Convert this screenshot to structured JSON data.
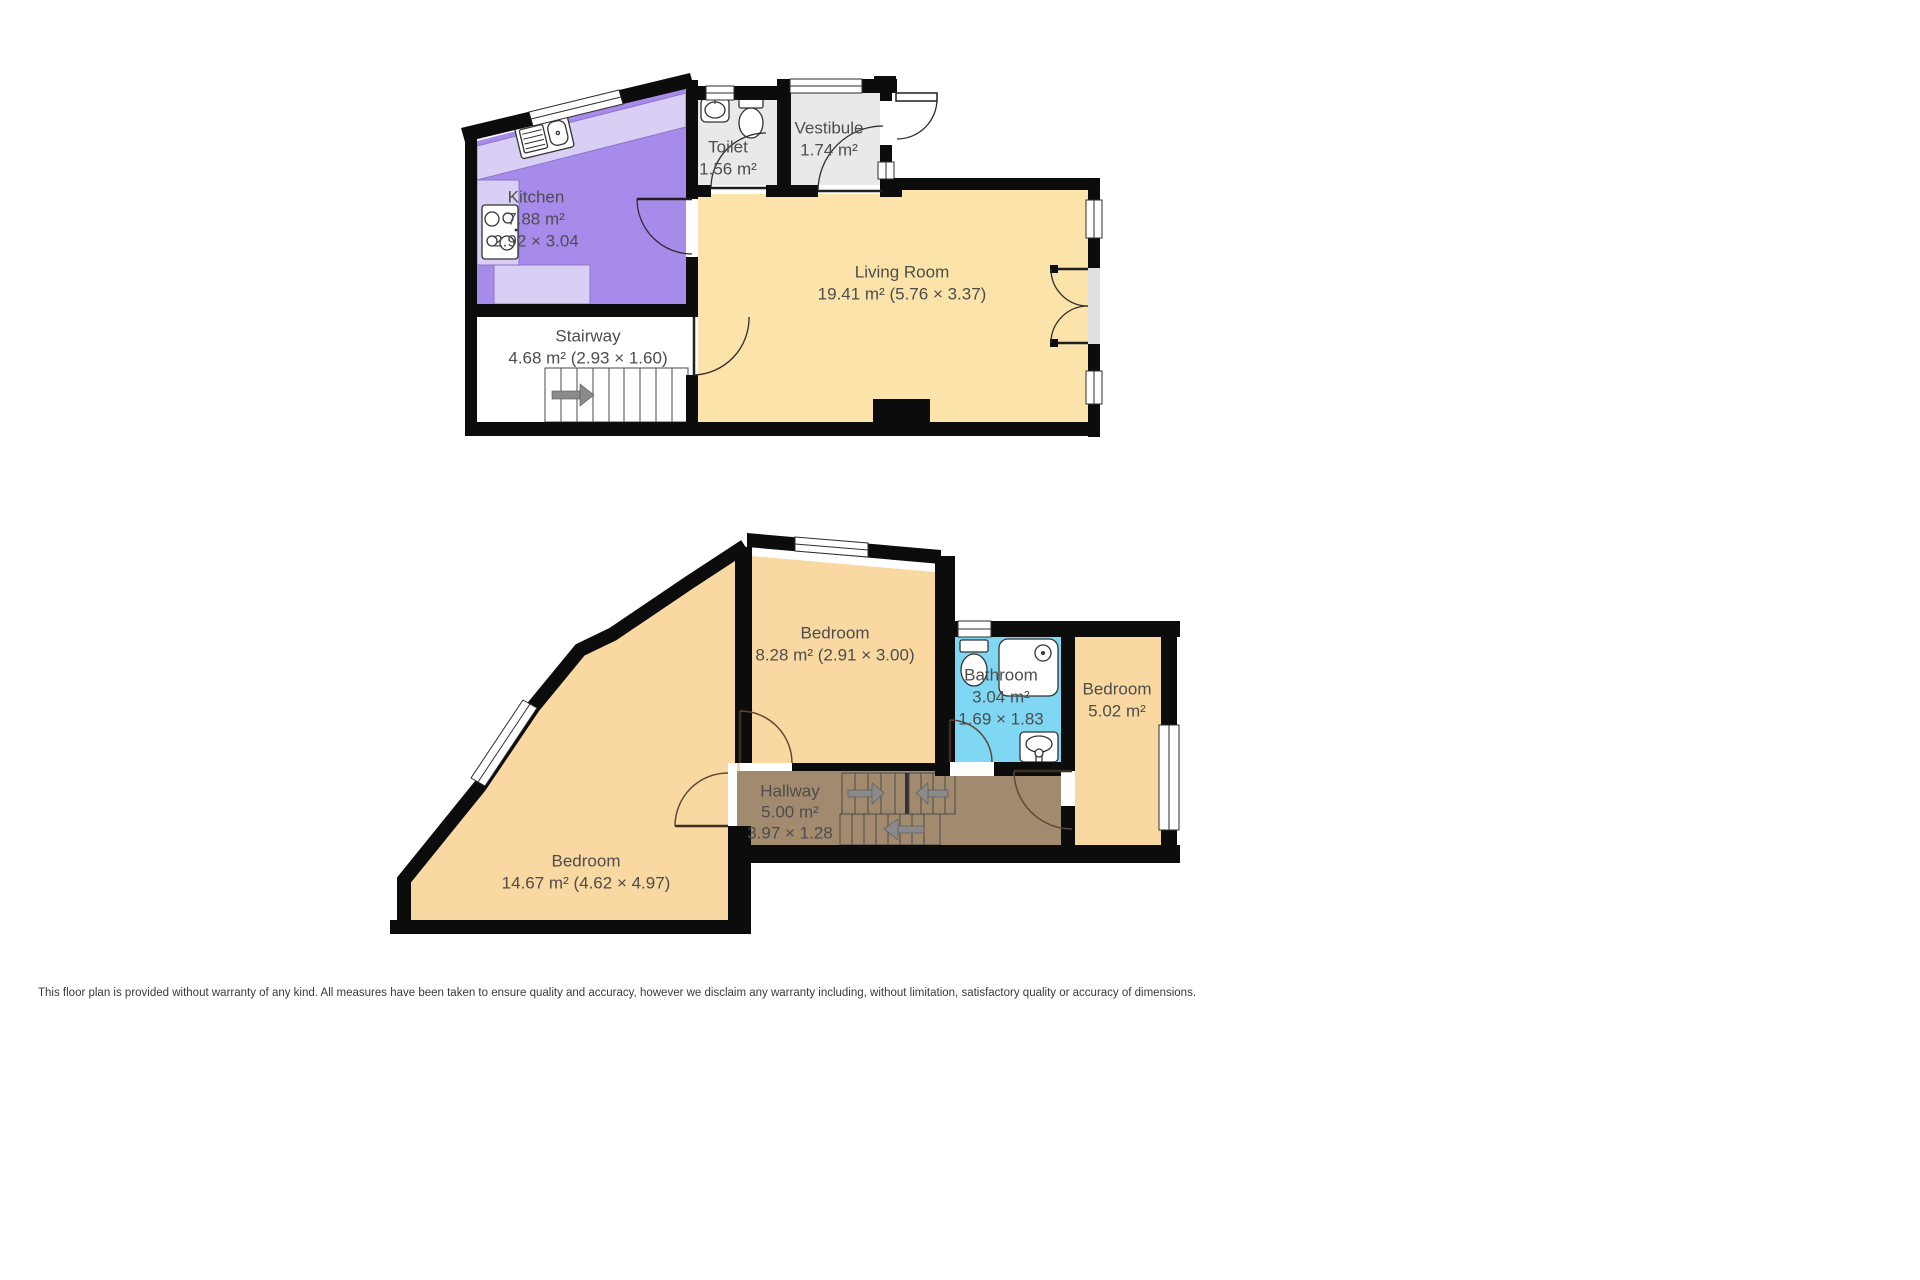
{
  "upper_floor": {
    "kitchen": {
      "name": "Kitchen",
      "area": "7.88 m²",
      "dims": "2.92 × 3.04"
    },
    "toilet": {
      "name": "Toilet",
      "area": "1.56 m²"
    },
    "vestibule": {
      "name": "Vestibule",
      "area": "1.74 m²"
    },
    "living_room": {
      "name": "Living Room",
      "area_dims": "19.41 m² (5.76 × 3.37)"
    },
    "stairway": {
      "name": "Stairway",
      "area_dims": "4.68 m² (2.93 × 1.60)"
    }
  },
  "lower_floor": {
    "bedroom_large": {
      "name": "Bedroom",
      "area_dims": "14.67 m² (4.62 × 4.97)"
    },
    "bedroom_mid": {
      "name": "Bedroom",
      "area_dims": "8.28 m² (2.91 × 3.00)"
    },
    "bathroom": {
      "name": "Bathroom",
      "area": "3.04 m²",
      "dims": "1.69 × 1.83"
    },
    "bedroom_small": {
      "name": "Bedroom",
      "area": "5.02 m²"
    },
    "hallway": {
      "name": "Hallway",
      "area": "5.00 m²",
      "dims": "3.97 × 1.28"
    }
  },
  "disclaimer": "This floor plan is provided without warranty of any kind. All measures have been taken to ensure quality and accuracy, however we disclaim any warranty including, without limitation, satisfactory quality or accuracy of dimensions.",
  "colors": {
    "wall": "#0c0c0c",
    "living": "#fce3aa",
    "bedroom": "#fad8a2",
    "kitchen": "#a78bea",
    "kitchen_counter": "#d9cef4",
    "wet_room": "#e9e9e9",
    "bathroom": "#7fd7f3",
    "hallway": "#a18a6e",
    "door_threshold": "#e0e0e0",
    "stair_arrow": "#8a8a8a",
    "label": "#4d4d4d"
  }
}
